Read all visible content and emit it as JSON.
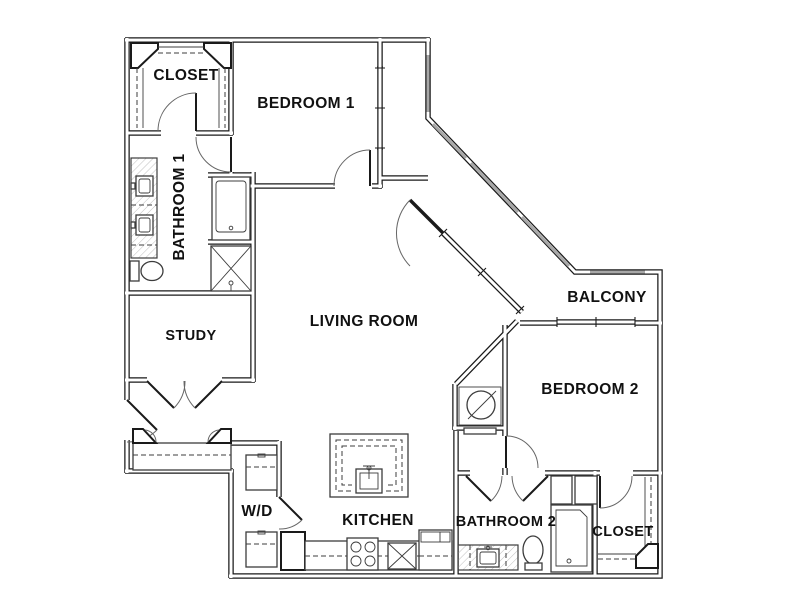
{
  "title": "Apartment Floor Plan",
  "colors": {
    "background": "#ffffff",
    "wall": "#1a1a1a",
    "glazing": "#a8a8a8",
    "fixture": "#3c3c3c"
  },
  "rooms": {
    "closet_top": "CLOSET",
    "bedroom1": "BEDROOM 1",
    "bathroom1": "BATHROOM 1",
    "study": "STUDY",
    "living_room": "LIVING ROOM",
    "balcony": "BALCONY",
    "bedroom2": "BEDROOM 2",
    "laundry": "W/D",
    "kitchen": "KITCHEN",
    "bathroom2": "BATHROOM 2",
    "closet_bottom": "CLOSET"
  }
}
